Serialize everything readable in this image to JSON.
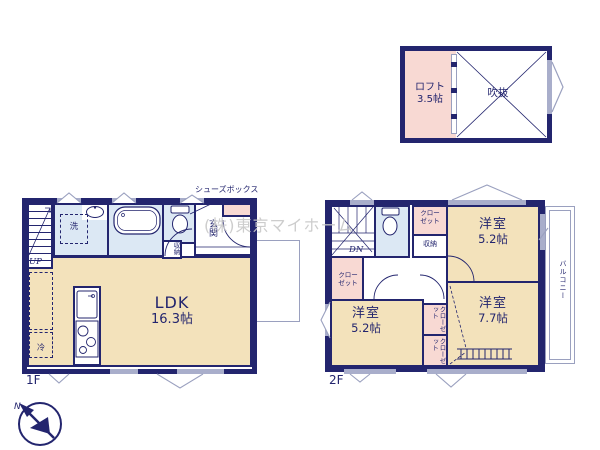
{
  "meta": {
    "kind": "japanese-real-estate-floor-plan"
  },
  "colors": {
    "wall_navy": "#23256e",
    "room_beige": "#f3e2bb",
    "closet_pink": "#f8d9d3",
    "wet_area_blue": "#dce8f4",
    "window_gray": "#a9aecb",
    "text_navy": "#23256e",
    "watermark_gray": "#c8c8c8"
  },
  "watermark": {
    "text": "(株)東京マイホーム"
  },
  "compass": {
    "north_label": "N"
  },
  "loft": {
    "room_label": "ロフト",
    "room_size": "3.5帖",
    "void_label": "吹抜"
  },
  "floor1": {
    "floor_label": "1F",
    "stairs_label": "UP",
    "washer_label": "洗",
    "storage_label": "収納",
    "entrance_label": "玄関",
    "shoebox_label": "シューズボックス",
    "ldk_label": "LDK",
    "ldk_size": "16.3帖",
    "fridge_label": "冷"
  },
  "floor2": {
    "floor_label": "2F",
    "stairs_label": "DN",
    "closet_top_label": "クローゼット",
    "closet_left_label": "クローゼット",
    "closet_mid1_label": "クローゼット",
    "closet_mid2_label": "クローゼット",
    "storage_label": "収納",
    "bedroom_tr_label": "洋室",
    "bedroom_tr_size": "5.2帖",
    "bedroom_bl_label": "洋室",
    "bedroom_bl_size": "5.2帖",
    "bedroom_br_label": "洋室",
    "bedroom_br_size": "7.7帖",
    "balcony_label": "バルコニー"
  }
}
